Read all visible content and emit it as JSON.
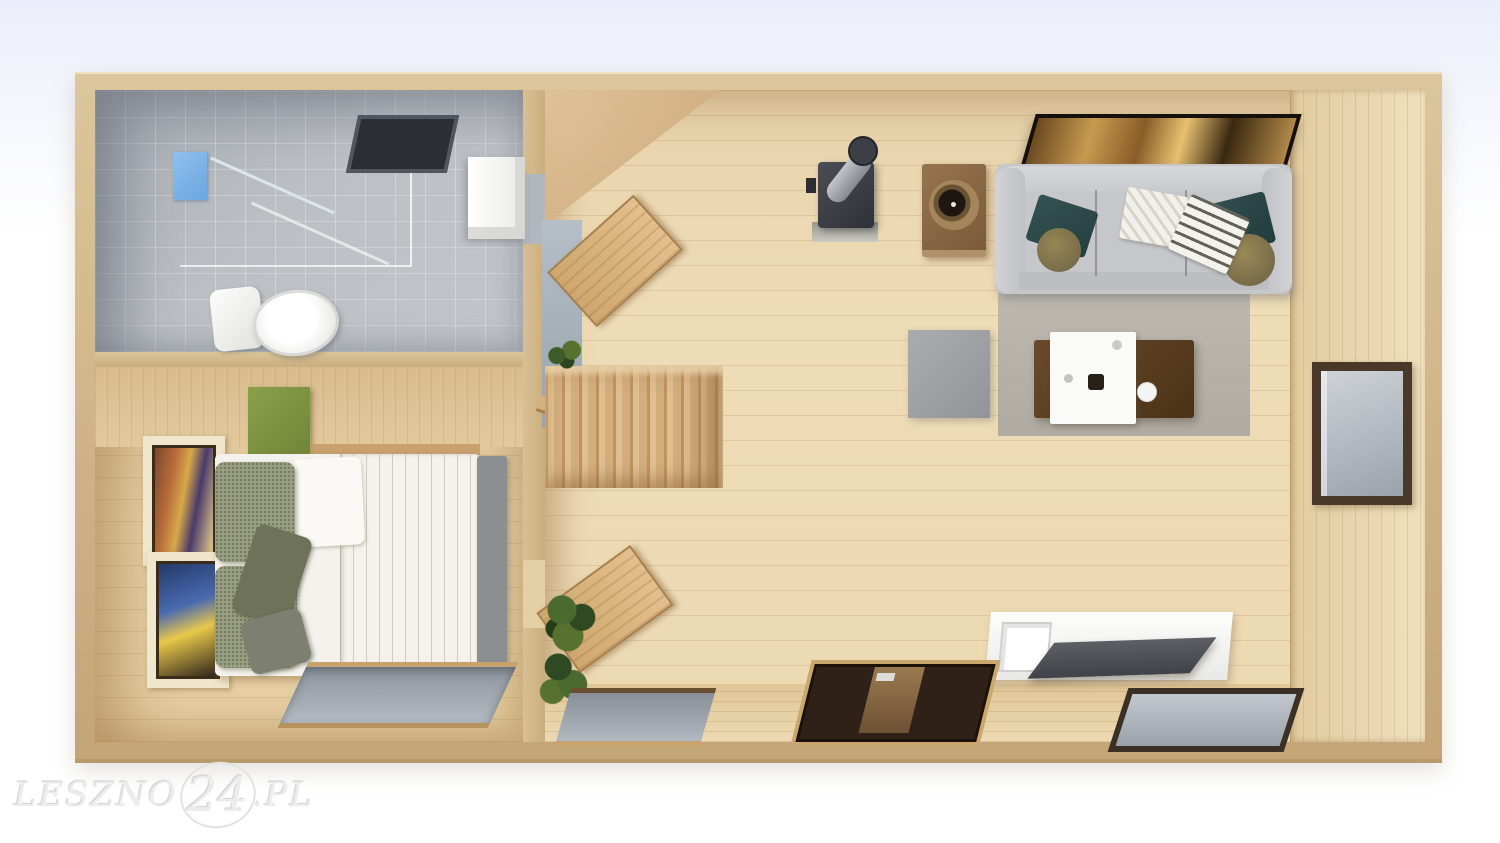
{
  "watermark": {
    "text_left": "LESZNO",
    "text_number": "24",
    "text_right": ".PL"
  },
  "colors": {
    "background_top": "#ebeefa",
    "background": "#ffffff",
    "wall_tan": "#cfb387",
    "living_floor_wood": "#ecd9b2",
    "bedroom_floor_wood": "#e6cfa4",
    "bathroom_tile": "#b7bbc0",
    "sofa_gray": "#c6c7ca",
    "rug_gray": "#b6b2a9",
    "ottoman_gray": "#9fa1a4",
    "coffee_table_brown": "#5c3e26",
    "tray_white": "#fafaf8",
    "stove_dark": "#3a3e44",
    "side_table_brown": "#8a6a48",
    "pillow_teal": "#2c4747",
    "cushion_olive": "#8a7c55",
    "bed_duvet_white": "#f4f2ec",
    "bed_pillow_olive": "#9aa083",
    "cabinet_green": "#7a8f3e",
    "open_door_wood": "#d4ab72",
    "entry_door_dark": "#2f2117",
    "window_frame_brown": "#4a3828",
    "window_glass_gray": "#b9bec5",
    "plant_green": "#3e5c28",
    "shower_panel_blue": "#7cb2e6",
    "watermark_gray": "#ececec"
  },
  "scene": {
    "view": "top-down 3D render of a small one-bedroom home floor plan",
    "rooms": [
      {
        "name": "bathroom",
        "items": [
          "shower-enclosure",
          "shower-panel",
          "shower-bars",
          "toilet",
          "ceiling-vent",
          "sink-cabinet"
        ]
      },
      {
        "name": "bedroom",
        "items": [
          "wall-art-top",
          "wall-art-bottom",
          "green-cabinet",
          "double-bed",
          "white-pillow",
          "olive-pillows",
          "bench",
          "south-window"
        ]
      },
      {
        "name": "living-room",
        "items": [
          "open-door-to-bathroom",
          "open-door-to-bedroom",
          "staircase",
          "stairwell-void",
          "handrail",
          "small-plant",
          "large-plants",
          "wood-stove",
          "stove-pipe",
          "side-table",
          "round-bowl",
          "tv-screen",
          "sofa",
          "teal-pillows",
          "round-cushions",
          "knit-blanket",
          "striped-blanket",
          "rug",
          "ottoman",
          "coffee-table",
          "serving-tray",
          "cup",
          "east-window",
          "desk",
          "monitor",
          "desk-chair",
          "south-entry-door",
          "south-window-left",
          "south-window-right"
        ]
      }
    ]
  }
}
